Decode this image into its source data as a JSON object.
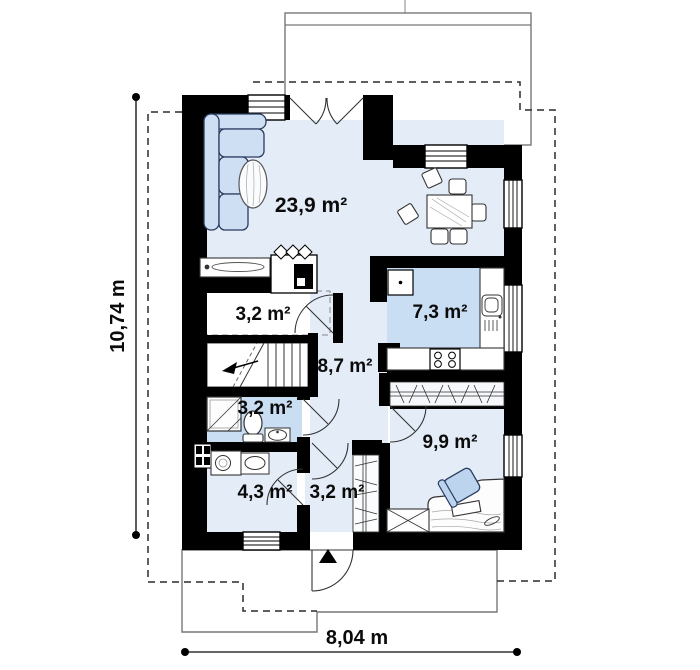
{
  "plan": {
    "title": "single-storey house floor plan",
    "rooms": [
      {
        "name": "living-room",
        "area_label": "23,9 m²"
      },
      {
        "name": "kitchen",
        "area_label": "7,3 m²"
      },
      {
        "name": "pantry",
        "area_label": "3,2 m²"
      },
      {
        "name": "hall",
        "area_label": "8,7 m²"
      },
      {
        "name": "bathroom",
        "area_label": "3,2 m²"
      },
      {
        "name": "bedroom",
        "area_label": "9,9 m²"
      },
      {
        "name": "utility-room",
        "area_label": "4,3 m²"
      },
      {
        "name": "entry-hall",
        "area_label": "3,2 m²"
      }
    ],
    "dimensions": {
      "height_label": "10,74 m",
      "width_label": "8,04 m"
    },
    "colors": {
      "wall": "#000000",
      "floor_light": "#e4ecf8",
      "floor_wet": "#c9ddf3",
      "furniture_fill": "#cfdff3",
      "furniture_stroke": "#2a3b60"
    }
  }
}
